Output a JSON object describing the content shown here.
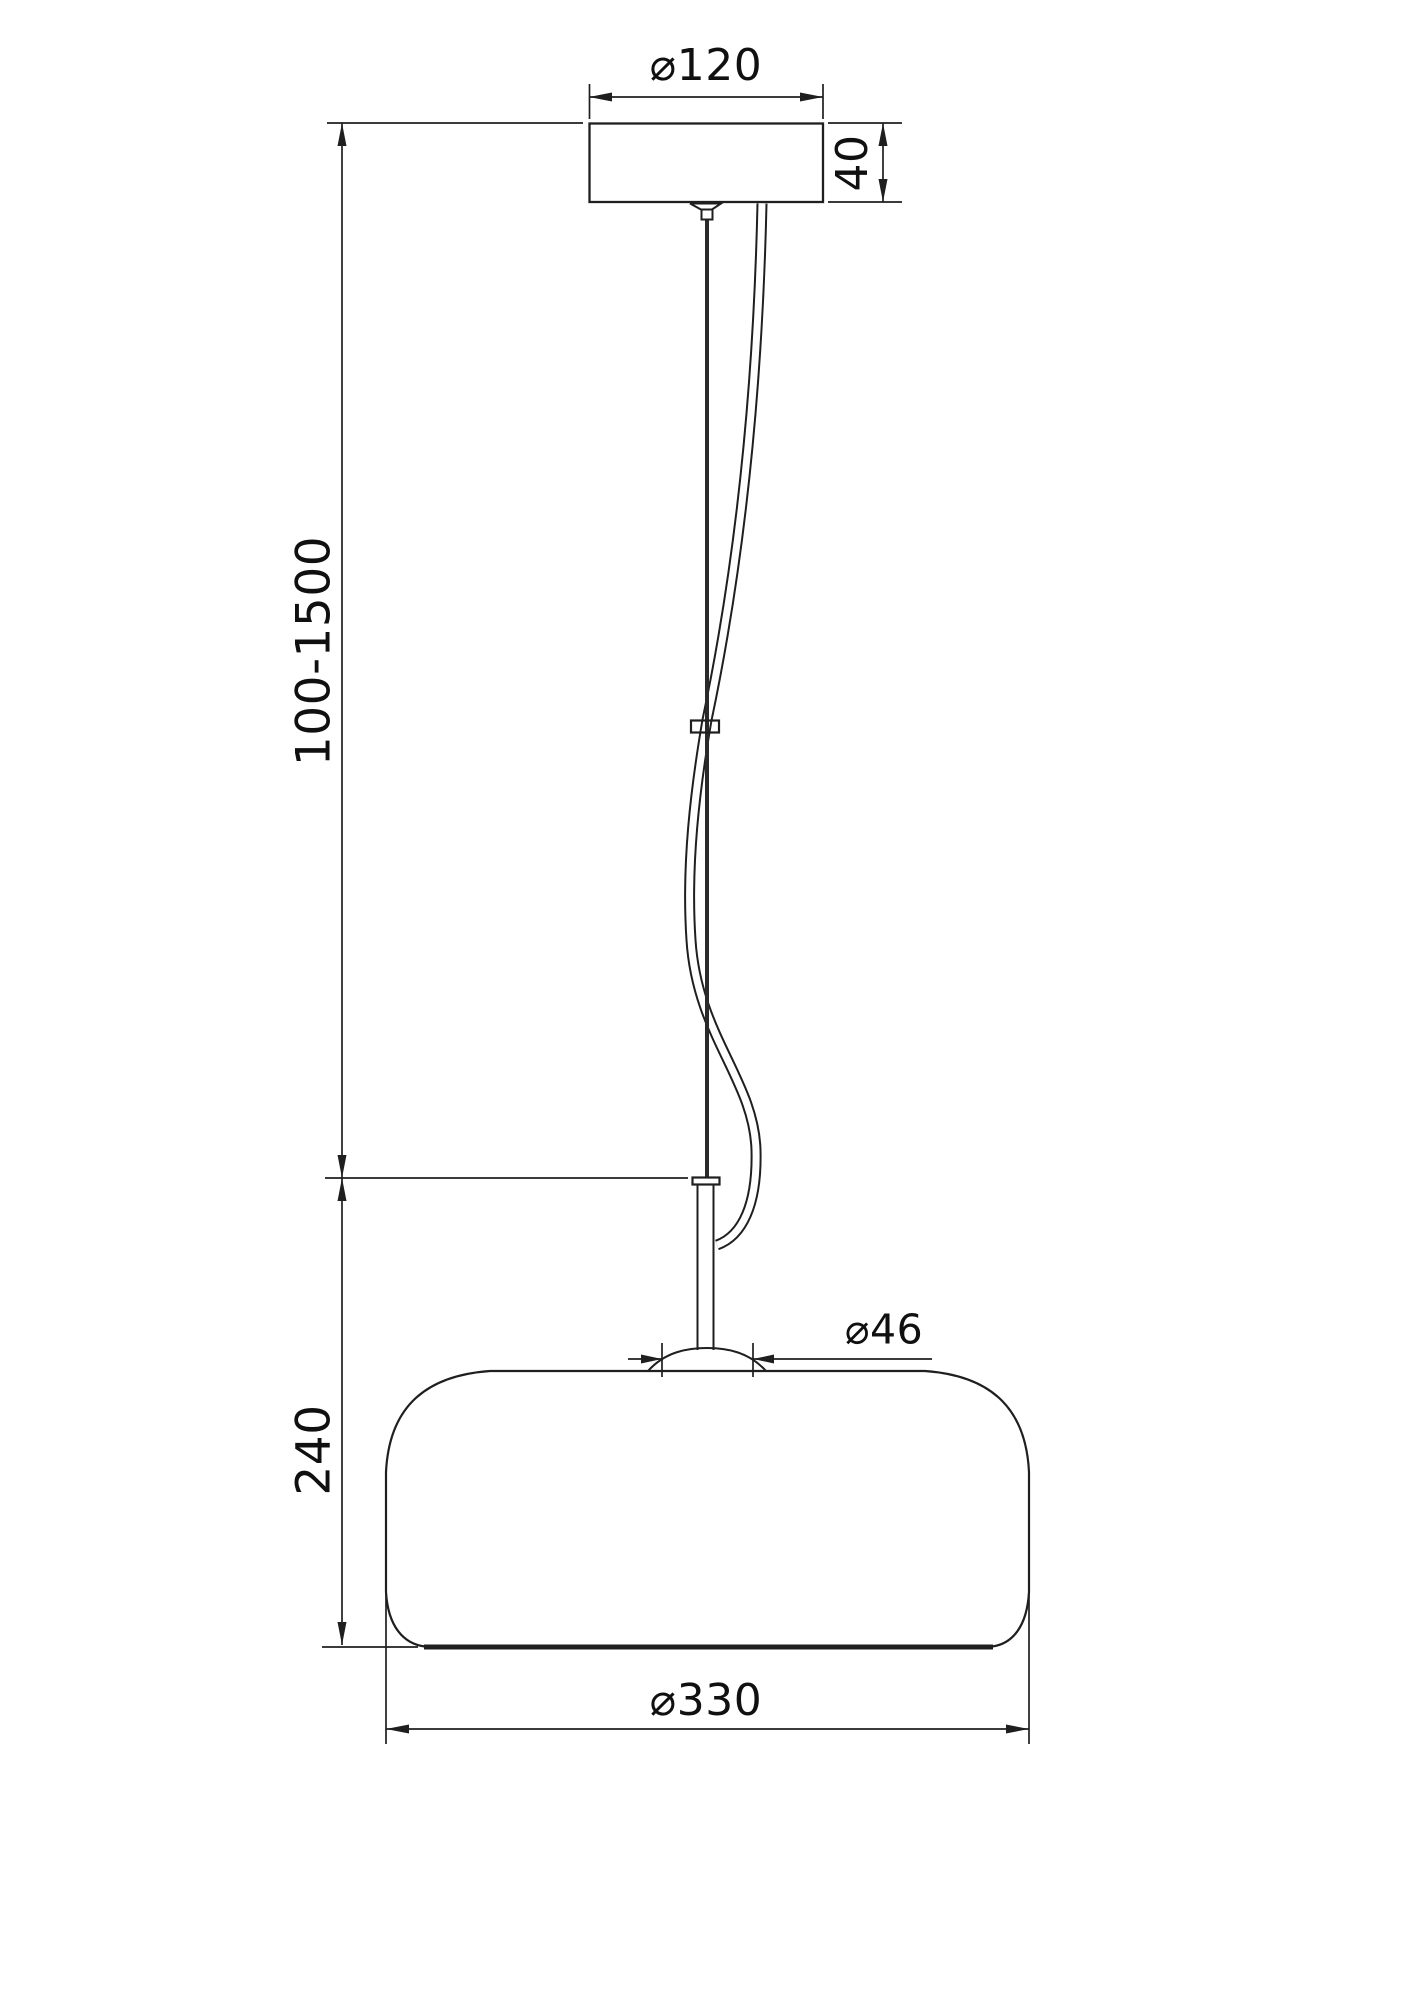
{
  "page": {
    "background": "#ffffff",
    "line_color": "#1f1f1f",
    "text_color": "#101010"
  },
  "drawing": {
    "type": "technical-dimension-drawing",
    "subject": "pendant lamp with ceiling canopy, adjustable suspension cable and rounded shade",
    "labels": {
      "canopy_diameter": "⌀120",
      "canopy_height": "40",
      "suspension_length": "100-1500",
      "fixture_height": "240",
      "socket_diameter": "⌀46",
      "shade_diameter": "⌀330"
    }
  }
}
